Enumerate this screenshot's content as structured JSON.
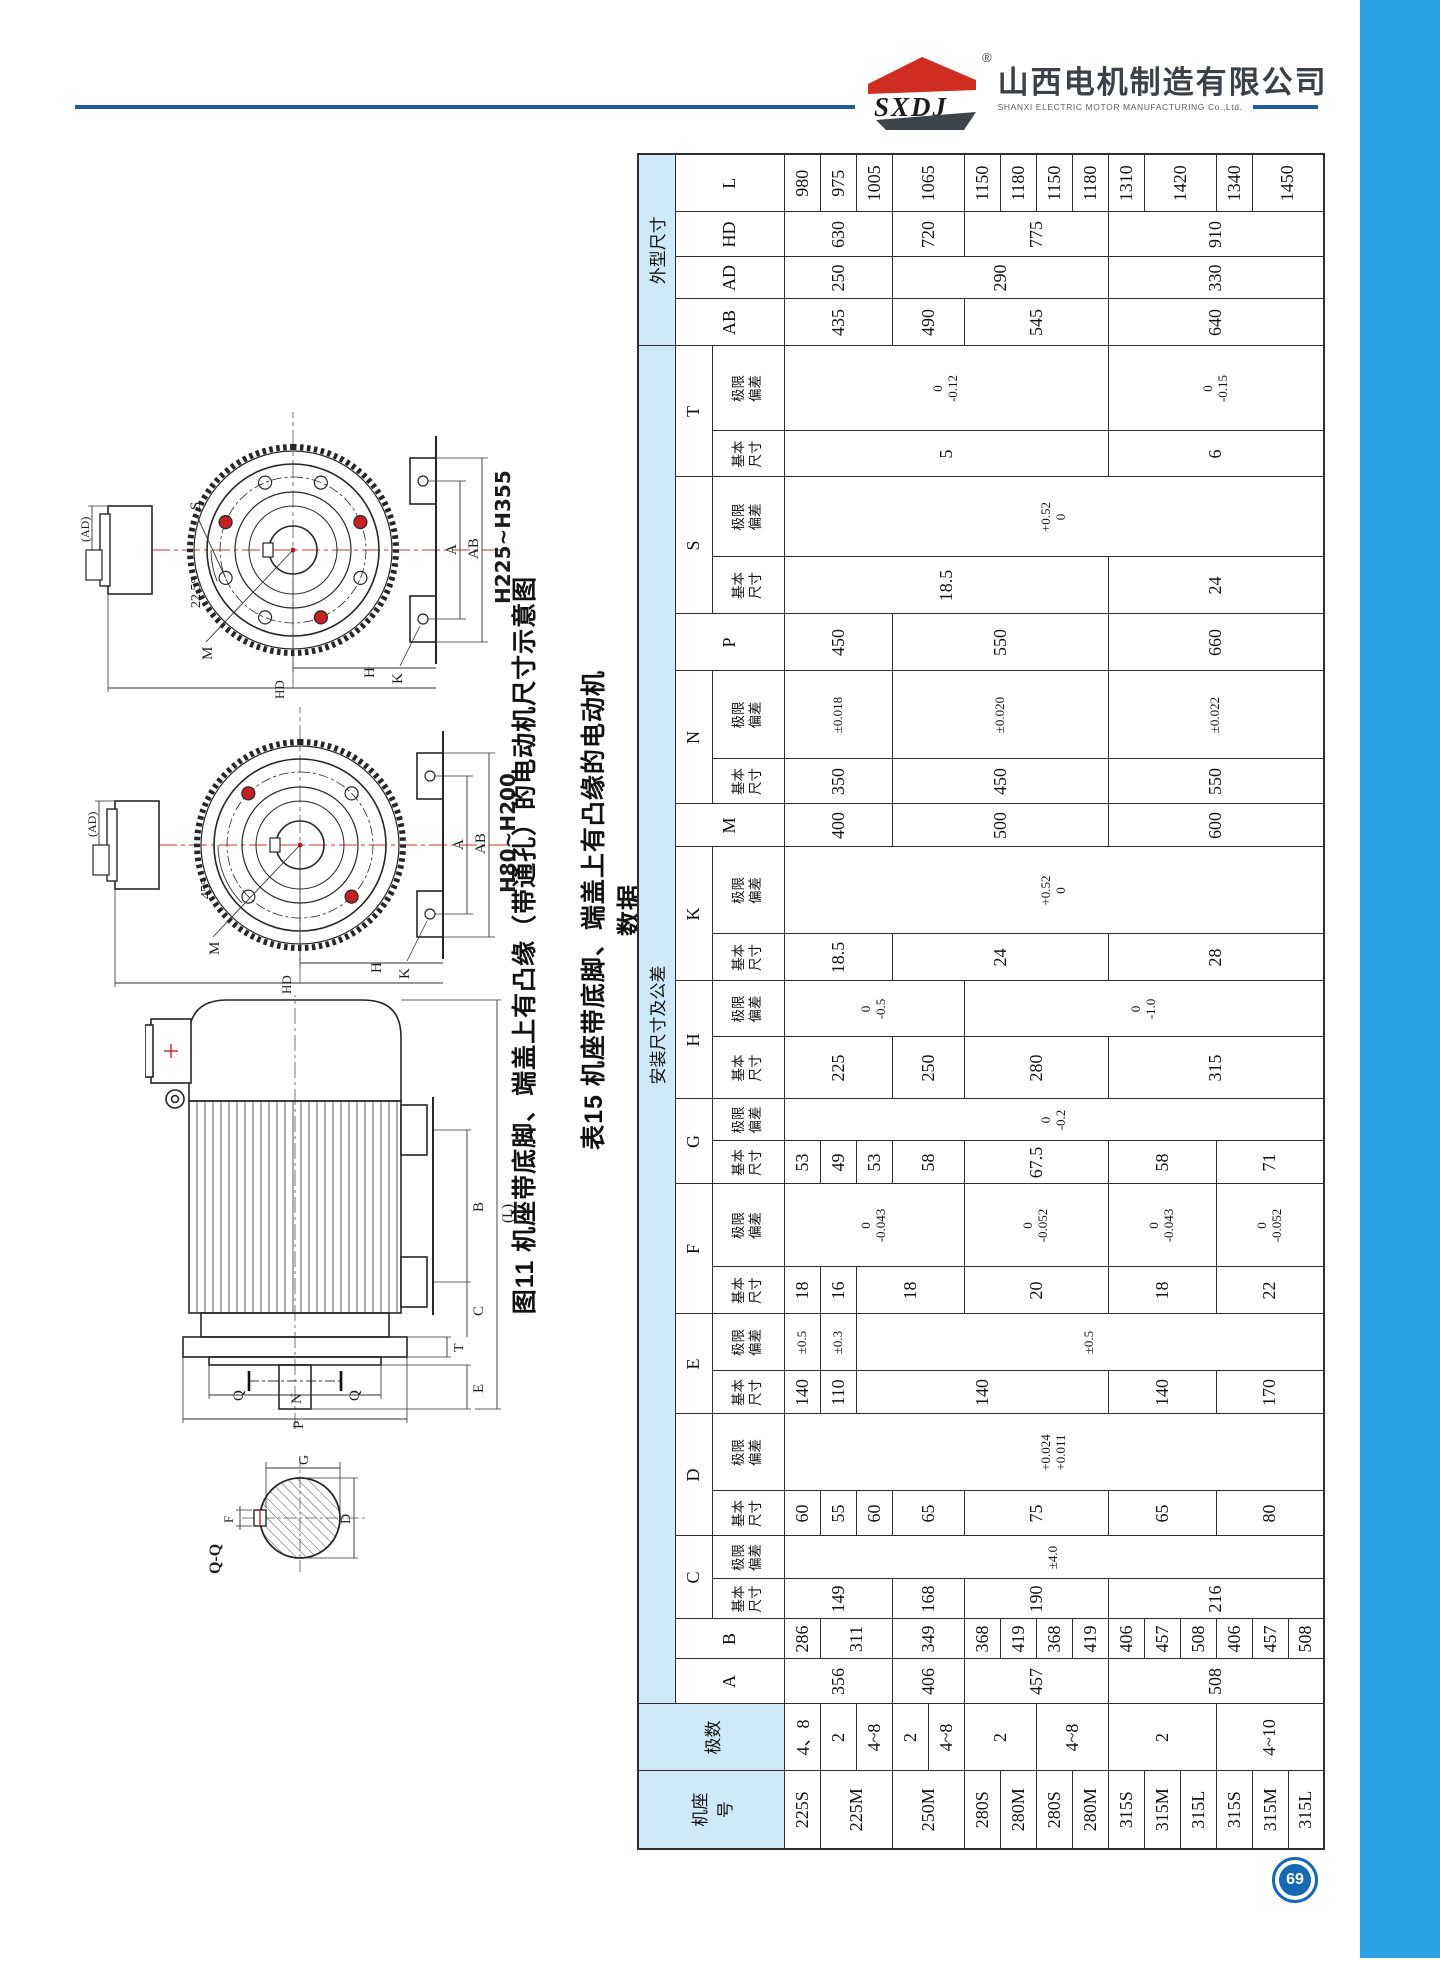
{
  "page_number": "69",
  "header": {
    "logo_abbr": "SXDJ",
    "registered_mark": "®",
    "company_cn": "山西电机制造有限公司",
    "company_en": "SHANXI ELECTRIC MOTOR MANUFACTURING Co.,Ltd."
  },
  "figure": {
    "caption": "图11 机座带底脚、端盖上有凸缘（带通孔）的电动机尺寸示意图",
    "section": {
      "title": "Q-Q",
      "f": "F",
      "g": "G",
      "d": "D"
    },
    "side": {
      "q_top": "Q",
      "q_bottom": "Q",
      "p": "P",
      "n": "N",
      "t": "T",
      "e": "E",
      "c": "C",
      "b": "B",
      "l": "(L)"
    },
    "end_small": {
      "range": "H80~H200",
      "angle": "45°",
      "ad": "(AD)",
      "m": "M",
      "k": "K",
      "h": "H",
      "hd": "HD",
      "a": "A",
      "ab": "AB"
    },
    "end_large": {
      "range": "H225~H355",
      "angle": "22.5°",
      "ad": "(AD)",
      "s": "S",
      "m": "M",
      "k": "K",
      "h": "H",
      "hd": "HD",
      "a": "A",
      "ab": "AB"
    }
  },
  "table": {
    "caption": "表15 机座带底脚、端盖上有凸缘的电动机数据",
    "corner_headers": [
      "机座\n号",
      "极数"
    ],
    "group_headers": [
      "安装尺寸及公差",
      "外型尺寸"
    ],
    "sub_basic": "基本\n尺寸",
    "sub_dev": "极限\n偏差",
    "col_widths": [
      78,
      67,
      45,
      40,
      40,
      43,
      45,
      77,
      43,
      57,
      47,
      83,
      43,
      42,
      62,
      56,
      47,
      87,
      43,
      45,
      88,
      57,
      57,
      80,
      46,
      85,
      47,
      42,
      45,
      58
    ],
    "letters": [
      {
        "t": "A",
        "grp": "i",
        "pair": false
      },
      {
        "t": "B",
        "grp": "i",
        "pair": false
      },
      {
        "t": "C",
        "grp": "i",
        "pair": true
      },
      {
        "t": "D",
        "grp": "i",
        "pair": true
      },
      {
        "t": "E",
        "grp": "i",
        "pair": true
      },
      {
        "t": "F",
        "grp": "i",
        "pair": true
      },
      {
        "t": "G",
        "grp": "i",
        "pair": true
      },
      {
        "t": "H",
        "grp": "i",
        "pair": true
      },
      {
        "t": "K",
        "grp": "i",
        "pair": true
      },
      {
        "t": "M",
        "grp": "i",
        "pair": false
      },
      {
        "t": "N",
        "grp": "i",
        "pair": true
      },
      {
        "t": "P",
        "grp": "i",
        "pair": false
      },
      {
        "t": "S",
        "grp": "i",
        "pair": true
      },
      {
        "t": "T",
        "grp": "i",
        "pair": true
      },
      {
        "t": "AB",
        "grp": "o",
        "pair": false
      },
      {
        "t": "AD",
        "grp": "o",
        "pair": false
      },
      {
        "t": "HD",
        "grp": "o",
        "pair": false
      },
      {
        "t": "L",
        "grp": "o",
        "pair": false
      }
    ],
    "body": [
      [
        {
          "t": "225S"
        },
        {
          "t": "4、8"
        },
        {
          "t": "356",
          "rs": 3
        },
        {
          "t": "286"
        },
        {
          "t": "149",
          "rs": 3
        },
        {
          "t": "±4.0",
          "rs": 15
        },
        {
          "t": "60"
        },
        {
          "t": "+0.024\n+0.011",
          "rs": 15
        },
        {
          "t": "140"
        },
        {
          "t": "±0.5"
        },
        {
          "t": "18"
        },
        {
          "t": "0\n-0.043",
          "rs": 5
        },
        {
          "t": "53"
        },
        {
          "t": "0\n-0.2",
          "rs": 15
        },
        {
          "t": "225",
          "rs": 3
        },
        {
          "t": "0\n-0.5",
          "rs": 5
        },
        {
          "t": "18.5",
          "rs": 3
        },
        {
          "t": "+0.52\n0",
          "rs": 15
        },
        {
          "t": "400",
          "rs": 3
        },
        {
          "t": "350",
          "rs": 3
        },
        {
          "t": "±0.018",
          "rs": 3
        },
        {
          "t": "450",
          "rs": 3
        },
        {
          "t": "18.5",
          "rs": 9
        },
        {
          "t": "+0.52\n0",
          "rs": 15
        },
        {
          "t": "5",
          "rs": 9
        },
        {
          "t": "0\n-0.12",
          "rs": 9
        },
        {
          "t": "435",
          "rs": 3
        },
        {
          "t": "250",
          "rs": 3
        },
        {
          "t": "630",
          "rs": 3
        },
        {
          "t": "980"
        }
      ],
      [
        {
          "t": "225M",
          "rs": 2
        },
        {
          "t": "2"
        },
        {
          "t": "311",
          "rs": 2
        },
        {
          "t": "55"
        },
        {
          "t": "110"
        },
        {
          "t": "±0.3"
        },
        {
          "t": "16"
        },
        {
          "t": "49"
        },
        {
          "t": "975"
        }
      ],
      [
        {
          "t": "4~8"
        },
        {
          "t": "60"
        },
        {
          "t": "140",
          "rs": 7
        },
        {
          "t": "±0.5",
          "rs": 13
        },
        {
          "t": "18",
          "rs": 3
        },
        {
          "t": "53"
        },
        {
          "t": "1005"
        }
      ],
      [
        {
          "t": "250M",
          "rs": 2
        },
        {
          "t": "2"
        },
        {
          "t": "406",
          "rs": 2
        },
        {
          "t": "349",
          "rs": 2
        },
        {
          "t": "168",
          "rs": 2
        },
        {
          "t": "65",
          "rs": 2
        },
        {
          "t": "58",
          "rs": 2
        },
        {
          "t": "250",
          "rs": 2
        },
        {
          "t": "24",
          "rs": 6
        },
        {
          "t": "500",
          "rs": 6
        },
        {
          "t": "450",
          "rs": 6
        },
        {
          "t": "±0.020",
          "rs": 6
        },
        {
          "t": "550",
          "rs": 6
        },
        {
          "t": "490",
          "rs": 2
        },
        {
          "t": "290",
          "rs": 6
        },
        {
          "t": "720",
          "rs": 2
        },
        {
          "t": "1065",
          "rs": 2
        }
      ],
      [
        {
          "t": "4~8"
        }
      ],
      [
        {
          "t": "280S"
        },
        {
          "t": "2",
          "rs": 2
        },
        {
          "t": "457",
          "rs": 4
        },
        {
          "t": "368"
        },
        {
          "t": "190",
          "rs": 4
        },
        {
          "t": "75",
          "rs": 4
        },
        {
          "t": "20",
          "rs": 4
        },
        {
          "t": "0\n-0.052",
          "rs": 4
        },
        {
          "t": "67.5",
          "rs": 4
        },
        {
          "t": "280",
          "rs": 4
        },
        {
          "t": "0\n-1.0",
          "rs": 10
        },
        {
          "t": "545",
          "rs": 4
        },
        {
          "t": "775",
          "rs": 4
        },
        {
          "t": "1150"
        }
      ],
      [
        {
          "t": "280M"
        },
        {
          "t": "419"
        },
        {
          "t": "1180"
        }
      ],
      [
        {
          "t": "280S"
        },
        {
          "t": "4~8",
          "rs": 2
        },
        {
          "t": "368"
        },
        {
          "t": "1150"
        }
      ],
      [
        {
          "t": "280M"
        },
        {
          "t": "419"
        },
        {
          "t": "1180"
        }
      ],
      [
        {
          "t": "315S"
        },
        {
          "t": "2",
          "rs": 3
        },
        {
          "t": "508",
          "rs": 6
        },
        {
          "t": "406"
        },
        {
          "t": "216",
          "rs": 6
        },
        {
          "t": "65",
          "rs": 3
        },
        {
          "t": "140",
          "rs": 3
        },
        {
          "t": "18",
          "rs": 3
        },
        {
          "t": "0\n-0.043",
          "rs": 3
        },
        {
          "t": "58",
          "rs": 3
        },
        {
          "t": "315",
          "rs": 6
        },
        {
          "t": "28",
          "rs": 6
        },
        {
          "t": "600",
          "rs": 6
        },
        {
          "t": "550",
          "rs": 6
        },
        {
          "t": "±0.022",
          "rs": 6
        },
        {
          "t": "660",
          "rs": 6
        },
        {
          "t": "24",
          "rs": 6
        },
        {
          "t": "6",
          "rs": 6
        },
        {
          "t": "0\n-0.15",
          "rs": 6
        },
        {
          "t": "640",
          "rs": 6
        },
        {
          "t": "330",
          "rs": 6
        },
        {
          "t": "910",
          "rs": 6
        },
        {
          "t": "1310"
        }
      ],
      [
        {
          "t": "315M"
        },
        {
          "t": "457"
        },
        {
          "t": "1420",
          "rs": 2
        }
      ],
      [
        {
          "t": "315L"
        },
        {
          "t": "508"
        }
      ],
      [
        {
          "t": "315S"
        },
        {
          "t": "4~10",
          "rs": 3
        },
        {
          "t": "406"
        },
        {
          "t": "80",
          "rs": 3
        },
        {
          "t": "170",
          "rs": 3
        },
        {
          "t": "22",
          "rs": 3
        },
        {
          "t": "0\n-0.052",
          "rs": 3
        },
        {
          "t": "71",
          "rs": 3
        },
        {
          "t": "1340"
        }
      ],
      [
        {
          "t": "315M"
        },
        {
          "t": "457"
        },
        {
          "t": "1450",
          "rs": 2
        }
      ],
      [
        {
          "t": "315L"
        },
        {
          "t": "508"
        }
      ]
    ]
  },
  "colors": {
    "sidebar": "#2aa2e3",
    "rule": "#1a5c9c",
    "logo_red": "#cf2d21",
    "logo_dark": "#3d4449",
    "header_fill": "#cfe9f8",
    "accent_red": "#c42222",
    "badge": "#1668b0"
  }
}
